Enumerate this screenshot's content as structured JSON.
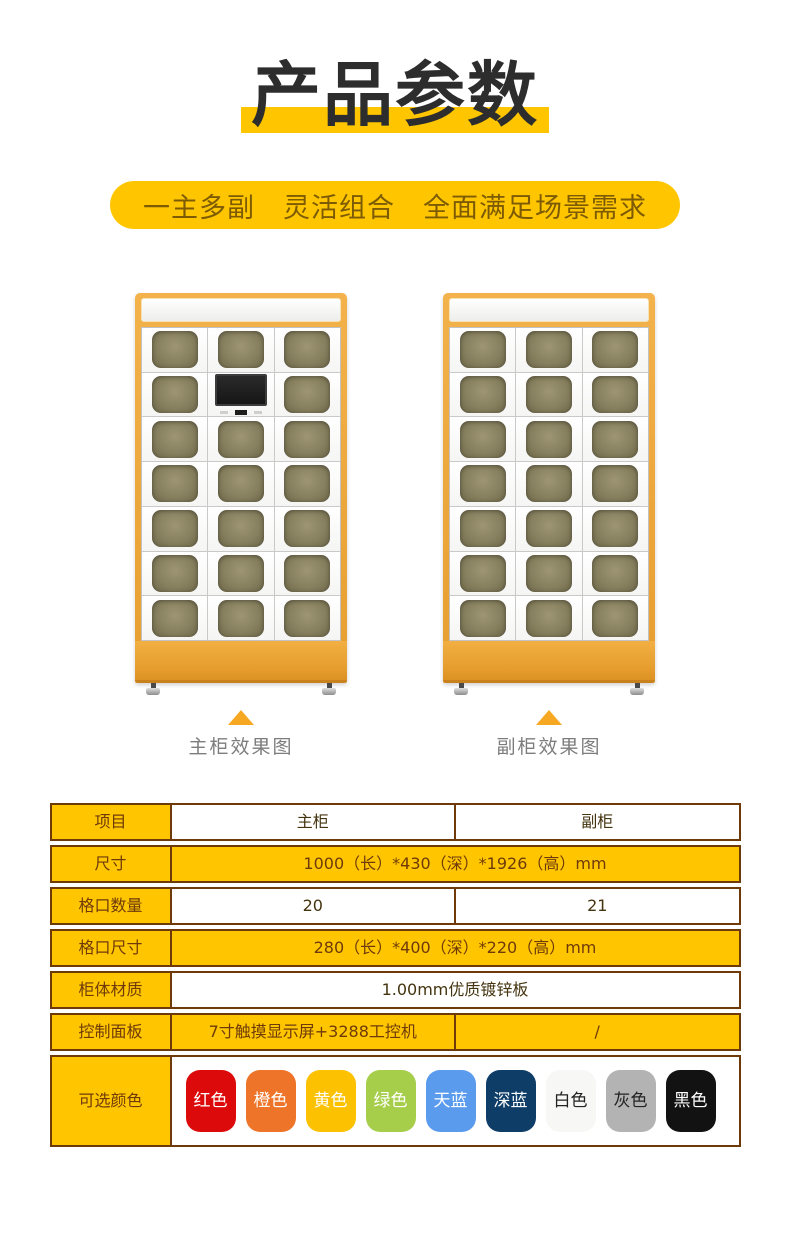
{
  "title": {
    "text": "产品参数"
  },
  "banner": {
    "text": "一主多副　灵活组合　全面满足场景需求"
  },
  "cabinets": {
    "main": {
      "caption": "主柜效果图",
      "rows": 7,
      "cols": 3,
      "screen_index": 4
    },
    "secondary": {
      "caption": "副柜效果图",
      "rows": 7,
      "cols": 3,
      "screen_index": -1
    }
  },
  "spec_table": {
    "columns": {
      "item": "项目",
      "main": "主柜",
      "secondary": "副柜"
    },
    "rows": {
      "size": {
        "label": "尺寸",
        "value": "1000（长）*430（深）*1926（高）mm"
      },
      "slot_count": {
        "label": "格口数量",
        "main": "20",
        "secondary": "21"
      },
      "slot_size": {
        "label": "格口尺寸",
        "value": "280（长）*400（深）*220（高）mm"
      },
      "material": {
        "label": "柜体材质",
        "value": "1.00mm优质镀锌板"
      },
      "control_panel": {
        "label": "控制面板",
        "main": "7寸触摸显示屏+3288工控机",
        "secondary": "/"
      },
      "colors": {
        "label": "可选颜色"
      }
    },
    "color_options": [
      {
        "name": "红色",
        "bg": "#dc0a0a",
        "fg": "#ffffff"
      },
      {
        "name": "橙色",
        "bg": "#ed7428",
        "fg": "#ffffff"
      },
      {
        "name": "黄色",
        "bg": "#fcc101",
        "fg": "#ffffff"
      },
      {
        "name": "绿色",
        "bg": "#a6ce4b",
        "fg": "#ffffff"
      },
      {
        "name": "天蓝",
        "bg": "#5b9bee",
        "fg": "#ffffff"
      },
      {
        "name": "深蓝",
        "bg": "#0e3d68",
        "fg": "#ffffff"
      },
      {
        "name": "白色",
        "bg": "#f7f7f5",
        "fg": "#222222"
      },
      {
        "name": "灰色",
        "bg": "#b3b3b3",
        "fg": "#222222"
      },
      {
        "name": "黑色",
        "bg": "#121212",
        "fg": "#ffffff"
      }
    ]
  },
  "theme": {
    "accent": "#FFC600",
    "table_border": "#6e3a0a",
    "triangle": "#f7a823",
    "caption_gray": "#7d7d7d"
  }
}
